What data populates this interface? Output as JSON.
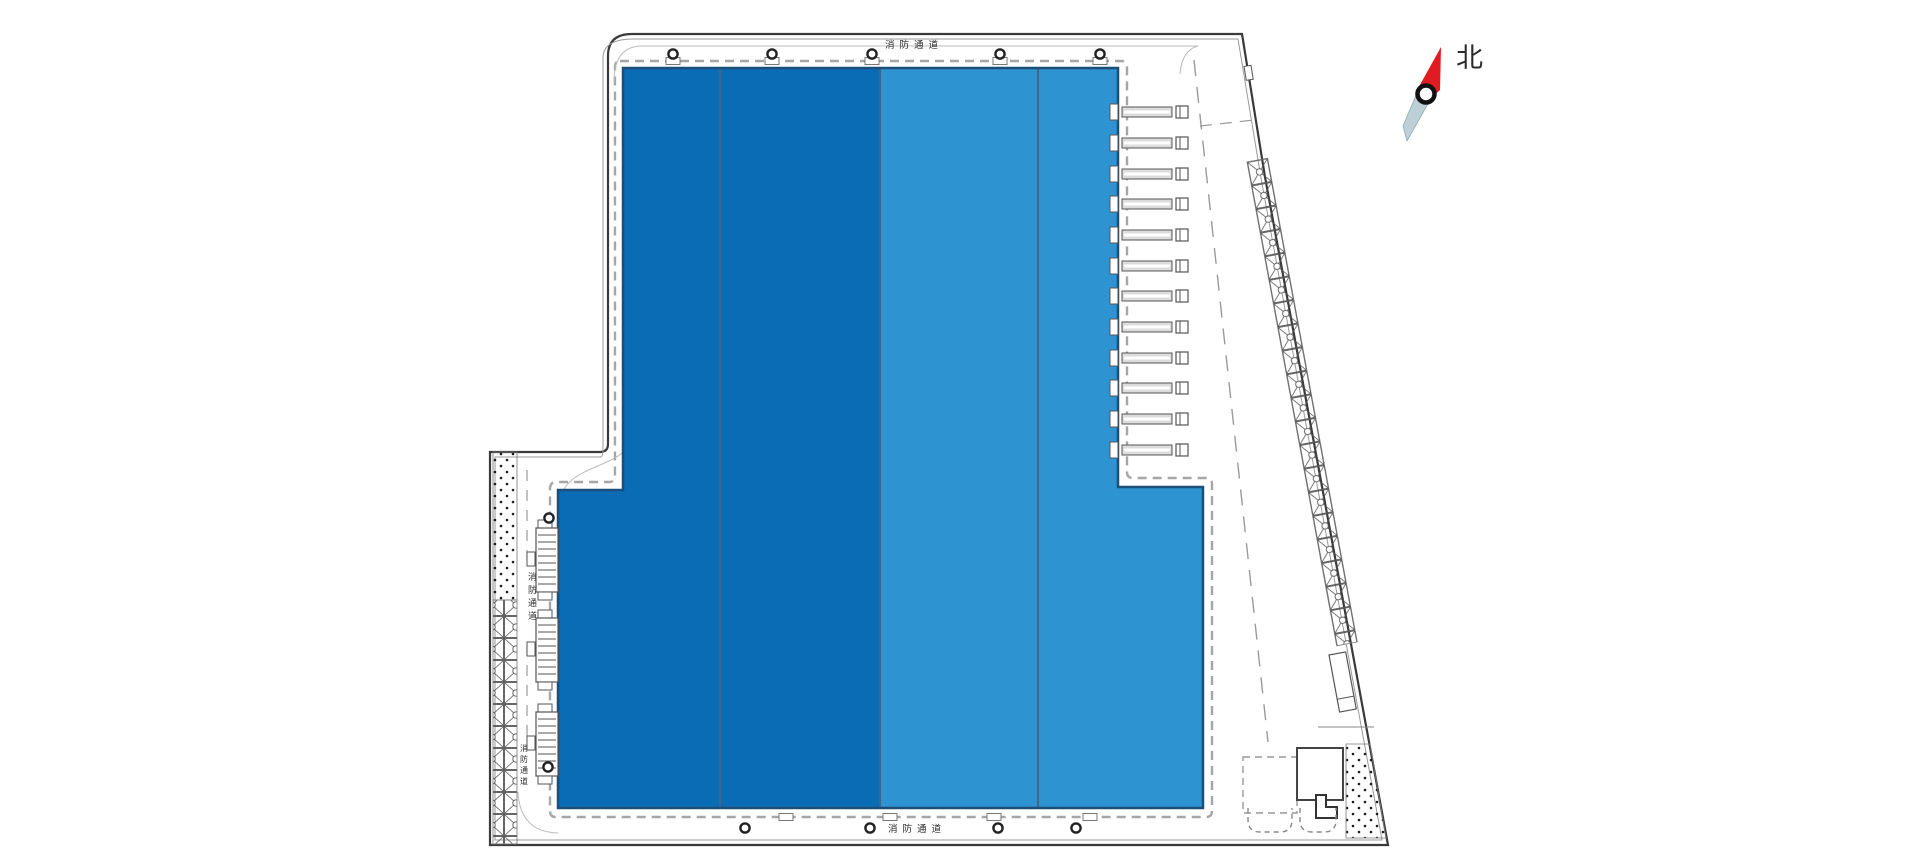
{
  "compass": {
    "north_label": "北"
  },
  "road_labels": {
    "top": "消防通道",
    "bottom": "消防通道",
    "left_upper": "消防通道",
    "left_lower": "消防通道"
  },
  "colors": {
    "warehouse_dark": "#0a6cb5",
    "warehouse_light": "#2e93d1",
    "warehouse_outline": "#1d4e79",
    "section_divider": "#3f6787",
    "compass_red": "#e11b22",
    "compass_tail": "#bdd0d8",
    "boundary_line": "#3a3a3a",
    "boundary_inner_line": "#999999",
    "road_marking": "#a6a6a6",
    "label_text": "#333333"
  }
}
